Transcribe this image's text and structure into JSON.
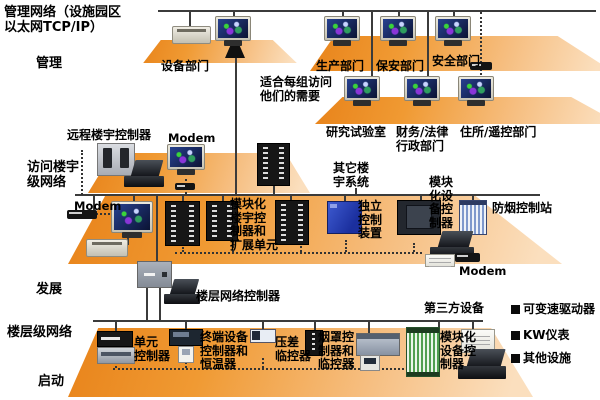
{
  "title": "管理网络（设施园区\n以太网TCP/IP）",
  "side_labels": {
    "management": "管理",
    "access_network": "访问楼宇\n级网络",
    "development": "发展",
    "floor_network": "楼层级网络",
    "startup": "启动"
  },
  "management_level": {
    "equipment_dept": "设备部门",
    "production_dept": "生产部门",
    "security_dept": "保安部门",
    "safety_dept": "安全部门",
    "note": "适合每组访问\n他们的需要",
    "research_lab": "研究试验室",
    "finance_legal": "财务/法律\n行政部门",
    "residence_remote": "住所/遥控部门"
  },
  "access_level": {
    "remote_building_controller": "远程楼宇控制器",
    "modem_top": "Modem",
    "modem_left": "Modem",
    "other_building_systems": "其它楼\n宇系统",
    "modular_building_controller": "模块化\n楼宇控\n制器和\n扩展单元",
    "independent_control": "独立\n控制\n装置",
    "modular_equipment_controller": "模块\n化设\n备控\n制器",
    "smoke_control_station": "防烟控制站",
    "modem_right": "Modem"
  },
  "floor_level": {
    "floor_network_controller": "楼层网络控制器",
    "third_party": "第三方设备",
    "unit_controller": "单元\n控制器",
    "terminal_controller": "终端设备\n控制器和\n恒温器",
    "pressure_monitor": "压差\n临控器",
    "hood_controller": "烟罩控\n制器和\n临控器",
    "modular_equipment_controller": "模块化\n设备控\n制器"
  },
  "legend": {
    "items": [
      "可变速驱动器",
      "KW仪表",
      "其他设施"
    ]
  },
  "colors": {
    "platform_dark": "#E8831A",
    "platform_light": "#FBDFBE",
    "line": "#3b3b3b"
  }
}
